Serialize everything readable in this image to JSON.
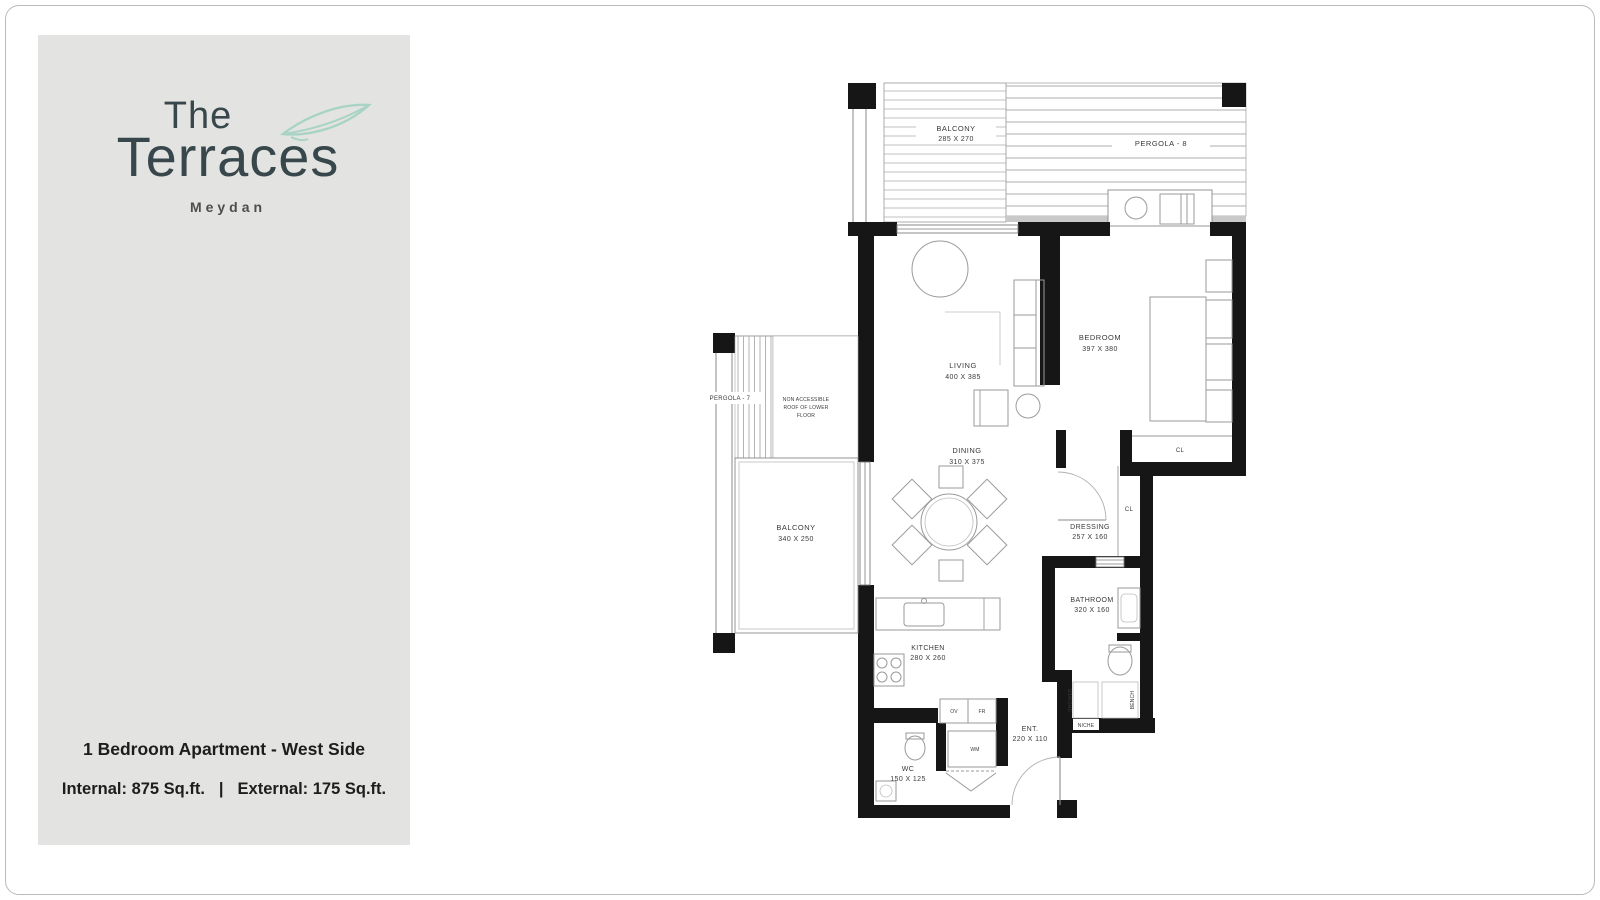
{
  "brand": {
    "the": "The",
    "terraces": "Terraces",
    "subtitle": "Meydan",
    "leaf_color": "#a9d3c5",
    "text_color": "#38474b"
  },
  "summary": {
    "title": "1 Bedroom Apartment - West Side",
    "internal": "Internal: 875 Sq.ft.",
    "divider": "|",
    "external": "External: 175 Sq.ft."
  },
  "plan": {
    "wall_color": "#161616",
    "labels": {
      "balcony_top_name": "BALCONY",
      "balcony_top_dims": "285 X 270",
      "pergola_8": "PERGOLA - 8",
      "pergola_7": "PERGOLA - 7",
      "roof_note_1": "NON ACCESSIBLE",
      "roof_note_2": "ROOF OF LOWER",
      "roof_note_3": "FLOOR",
      "balcony_left_name": "BALCONY",
      "balcony_left_dims": "340 X 250",
      "living_name": "LIVING",
      "living_dims": "400 X 385",
      "bedroom_name": "BEDROOM",
      "bedroom_dims": "397 X 380",
      "dining_name": "DINING",
      "dining_dims": "310 X 375",
      "dressing_name": "DRESSING",
      "dressing_dims": "257 X 160",
      "bathroom_name": "BATHROOM",
      "bathroom_dims": "320 X 160",
      "kitchen_name": "KITCHEN",
      "kitchen_dims": "280 X 260",
      "entrance_name": "ENT.",
      "entrance_dims": "220 X 110",
      "wc_name": "WC",
      "wc_dims": "150 X 125",
      "closet_bedroom": "CL",
      "closet_dressing": "CL",
      "oven": "OV",
      "fridge": "FR",
      "washing_machine": "WM",
      "shower": "SHOWER",
      "bench": "BENCH",
      "niche": "NICHE"
    }
  }
}
